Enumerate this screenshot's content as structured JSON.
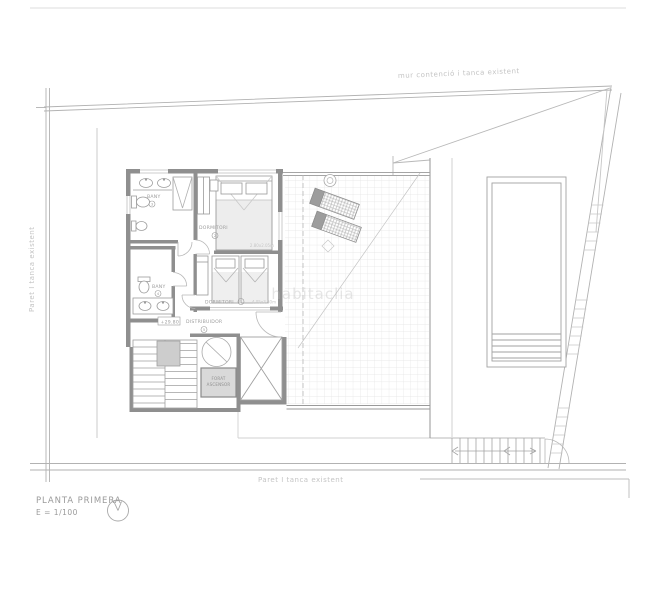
{
  "drawing": {
    "title": "PLANTA PRIMERA",
    "scale": "E = 1/100"
  },
  "boundaries": {
    "top_label": "mur contenció i tanca existent",
    "left_label": "Paret I tanca existent",
    "bottom_label": "Paret I tanca existent"
  },
  "rooms": {
    "bany1": {
      "label": "BANY",
      "num": "3"
    },
    "dormitori_ppal": {
      "label": "DORMITORI",
      "num": "2",
      "dims": "2.80x2.05m"
    },
    "dormitori2": {
      "label": "DORMITORI",
      "num": "1",
      "dims": "4.05x3.30m"
    },
    "bany2": {
      "label": "BANY",
      "num": "4"
    },
    "distribuidor": {
      "label": "DISTRIBUIDOR",
      "num": "5"
    },
    "level": "+29.80",
    "ascensor_l1": "FORAT",
    "ascensor_l2": "ASCENSOR"
  },
  "watermark": "habitaclia",
  "colors": {
    "wall": "#8f8f8f",
    "line": "#a8a8a8",
    "light_line": "#c8c8c8",
    "grid": "#e3e3e3",
    "text": "#9c9c9c",
    "faint_text": "#c4c4c4"
  }
}
